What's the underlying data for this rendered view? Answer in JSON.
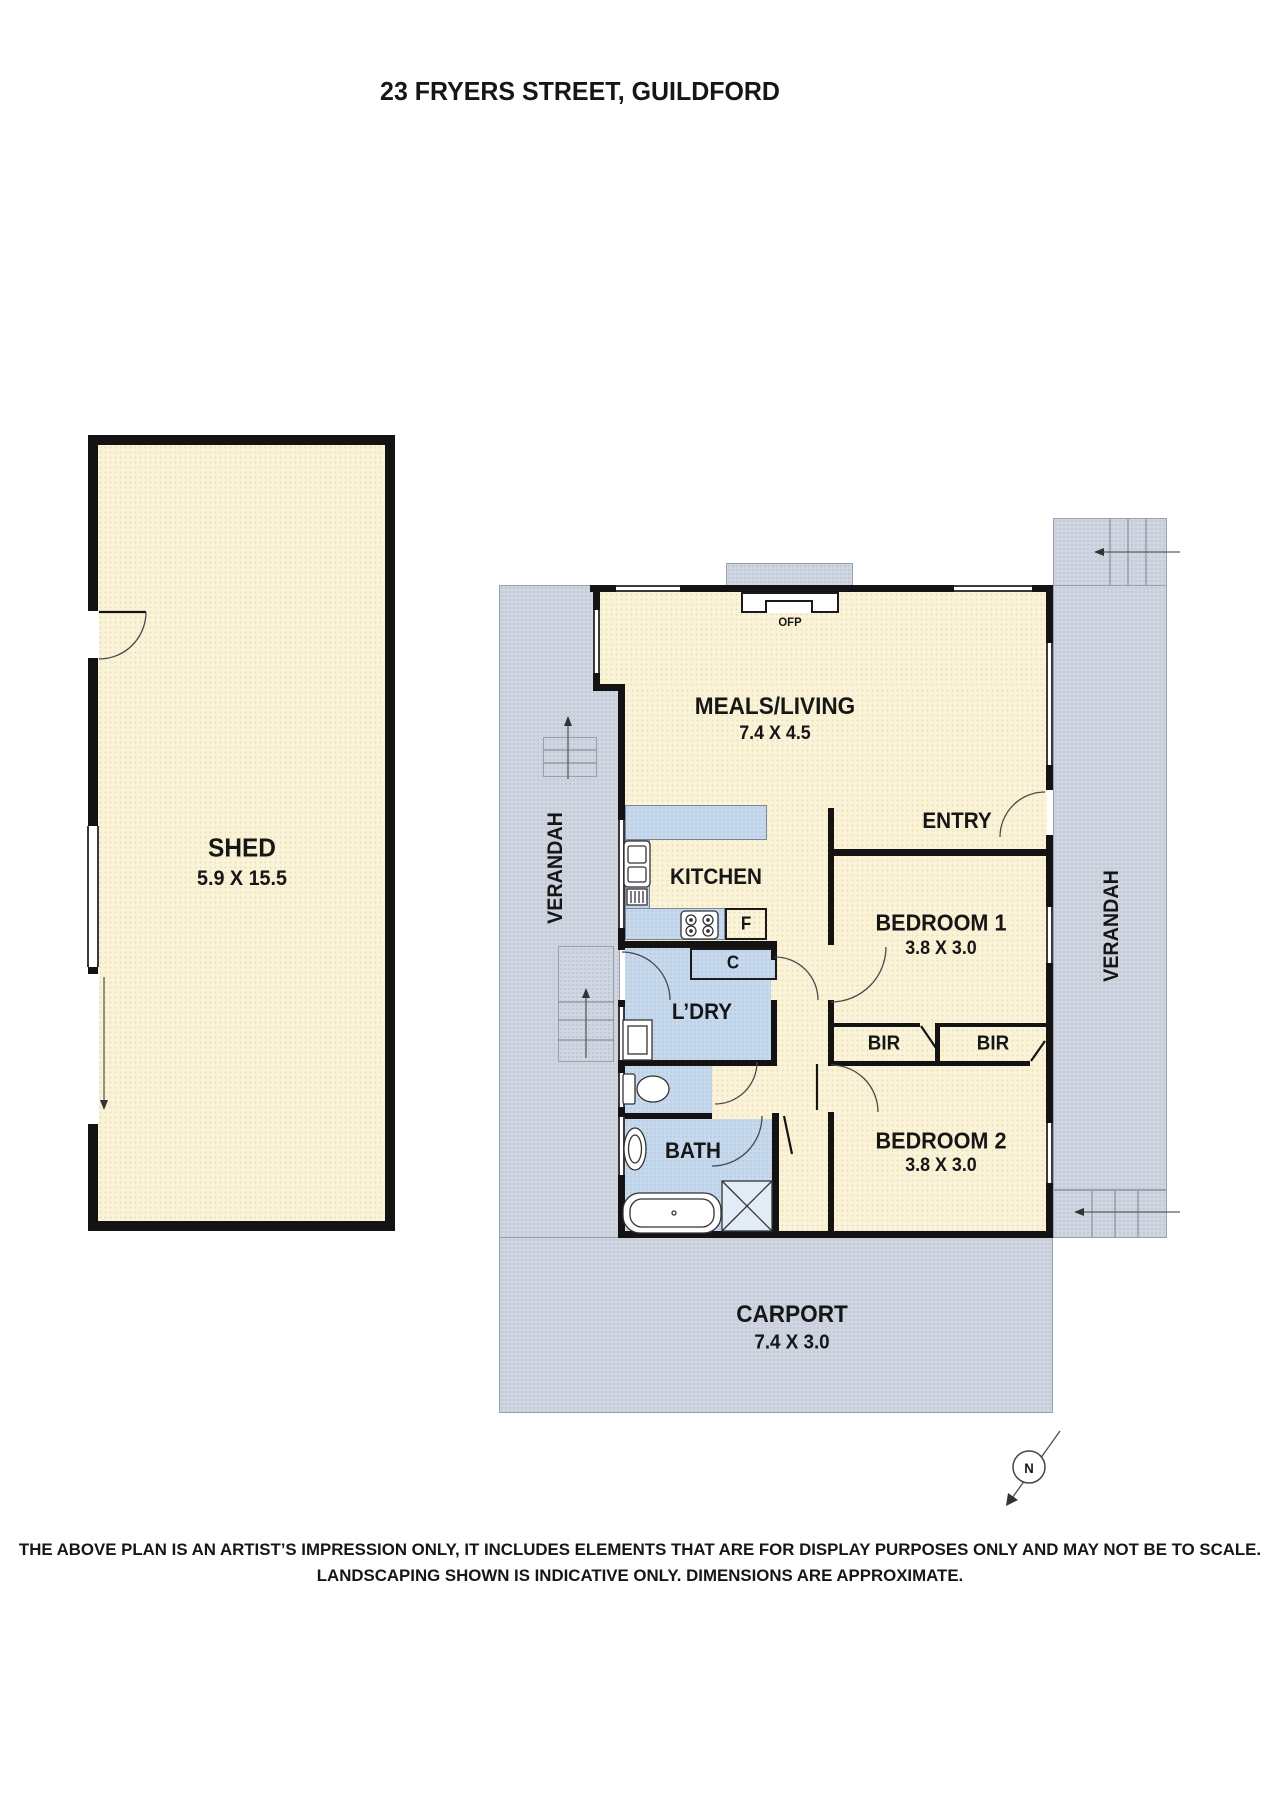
{
  "title": "23 FRYERS STREET, GUILDFORD",
  "plan": {
    "shed": {
      "name": "SHED",
      "dims": "5.9 X 15.5"
    },
    "meals": {
      "name": "MEALS/LIVING",
      "dims": "7.4 X 4.5"
    },
    "entry": {
      "name": "ENTRY"
    },
    "kitchen": {
      "name": "KITCHEN"
    },
    "bedroom1": {
      "name": "BEDROOM 1",
      "dims": "3.8 X 3.0"
    },
    "bedroom2": {
      "name": "BEDROOM 2",
      "dims": "3.8 X 3.0"
    },
    "laundry": {
      "name": "L’DRY"
    },
    "bath": {
      "name": "BATH"
    },
    "carport": {
      "name": "CARPORT",
      "dims": "7.4 X 3.0"
    },
    "verandah_left": {
      "name": "VERANDAH"
    },
    "verandah_right": {
      "name": "VERANDAH"
    },
    "bir_left": {
      "name": "BIR"
    },
    "bir_right": {
      "name": "BIR"
    },
    "fridge": {
      "name": "F"
    },
    "cupboard": {
      "name": "C"
    },
    "fireplace": {
      "name": "OFP"
    },
    "compass": {
      "name": "N"
    }
  },
  "footer": {
    "line1": "THE ABOVE PLAN IS AN ARTIST’S IMPRESSION ONLY, IT INCLUDES ELEMENTS THAT ARE FOR DISPLAY PURPOSES ONLY AND MAY NOT BE TO SCALE.",
    "line2": "LANDSCAPING SHOWN IS INDICATIVE ONLY. DIMENSIONS ARE APPROXIMATE."
  },
  "colors": {
    "cream": "#FBF3D8",
    "grey": "#CFD5E1",
    "blue": "#C7D9EC",
    "wall": "#131313"
  }
}
